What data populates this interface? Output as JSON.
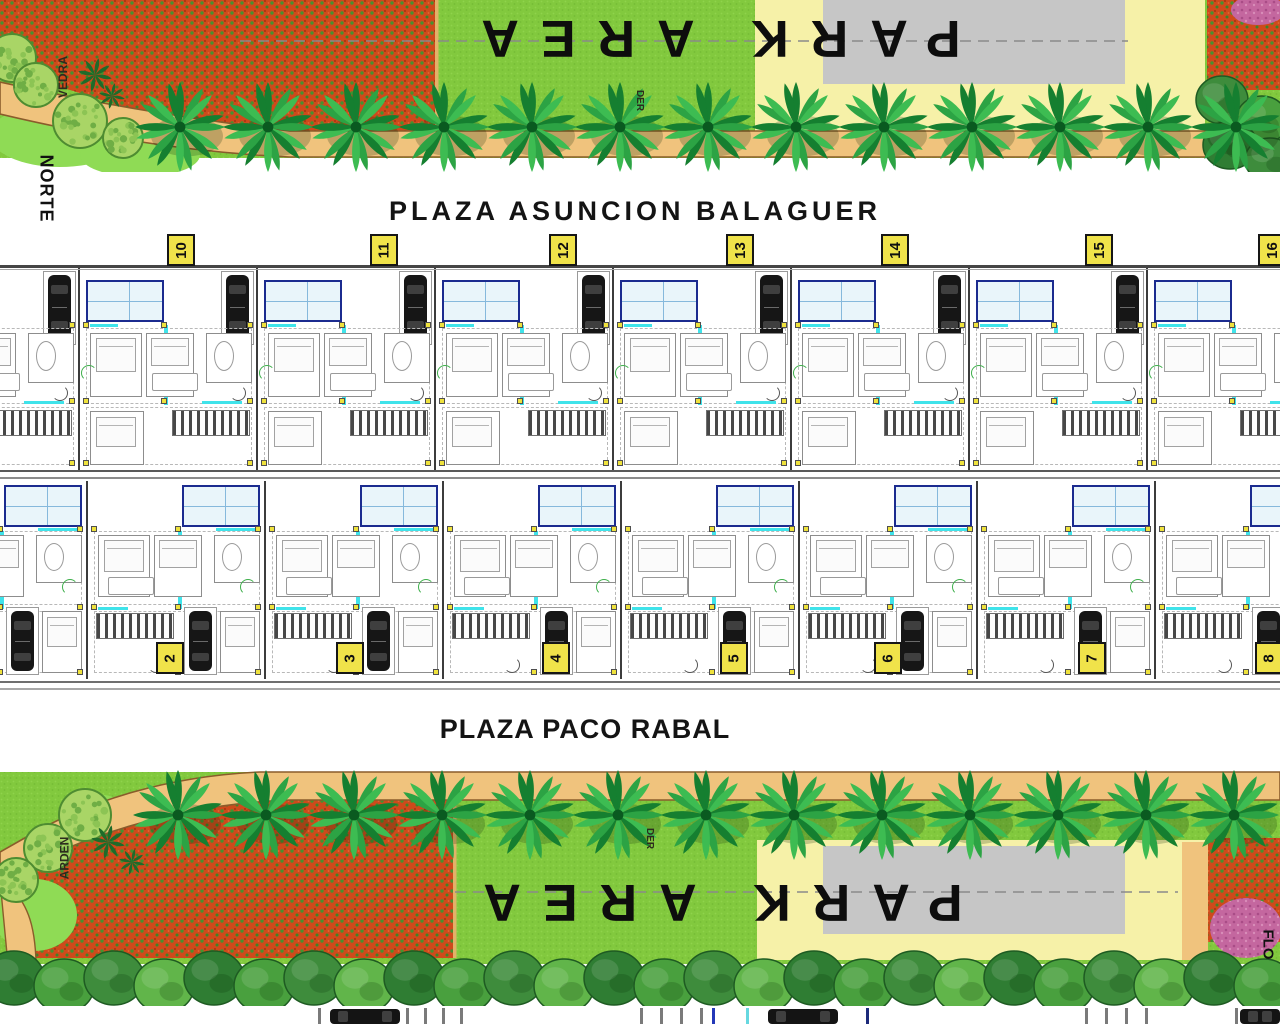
{
  "labels": {
    "north": "NORTE",
    "park_area_top": "PARK AREA",
    "park_area_bottom": "PARK AREA",
    "plaza_top": "PLAZA ASUNCION BALAGUER",
    "plaza_bottom": "PLAZA PACO RABAL",
    "street_edge_top_left": "VEDRA",
    "street_edge_bottom_left": "ARDEN",
    "small_marker_top": "DER",
    "small_marker_bottom": "DER",
    "street_edge_bottom_right": "FLO"
  },
  "plots": {
    "top_row": [
      "10",
      "11",
      "12",
      "13",
      "14",
      "15",
      "16"
    ],
    "bottom_row": [
      "2",
      "3",
      "4",
      "5",
      "6",
      "7",
      "8"
    ]
  },
  "colors": {
    "grass_green": "#82c93e",
    "grass_light": "#8fdb55",
    "palm_green": "#2ca344",
    "path_tan": "#f0c37d",
    "path_edge_brown": "#8a5c2b",
    "flowerbed_orange": "#ce4a1b",
    "flowerbed_pink": "#c4679f",
    "paved_gray": "#c6c6c6",
    "paved_yellow": "#f6f1a8",
    "badge_yellow": "#f0e34a",
    "pool_blue": "#1b2b8f",
    "wall_cyan": "#3fe3ea",
    "label_black": "#111111"
  }
}
